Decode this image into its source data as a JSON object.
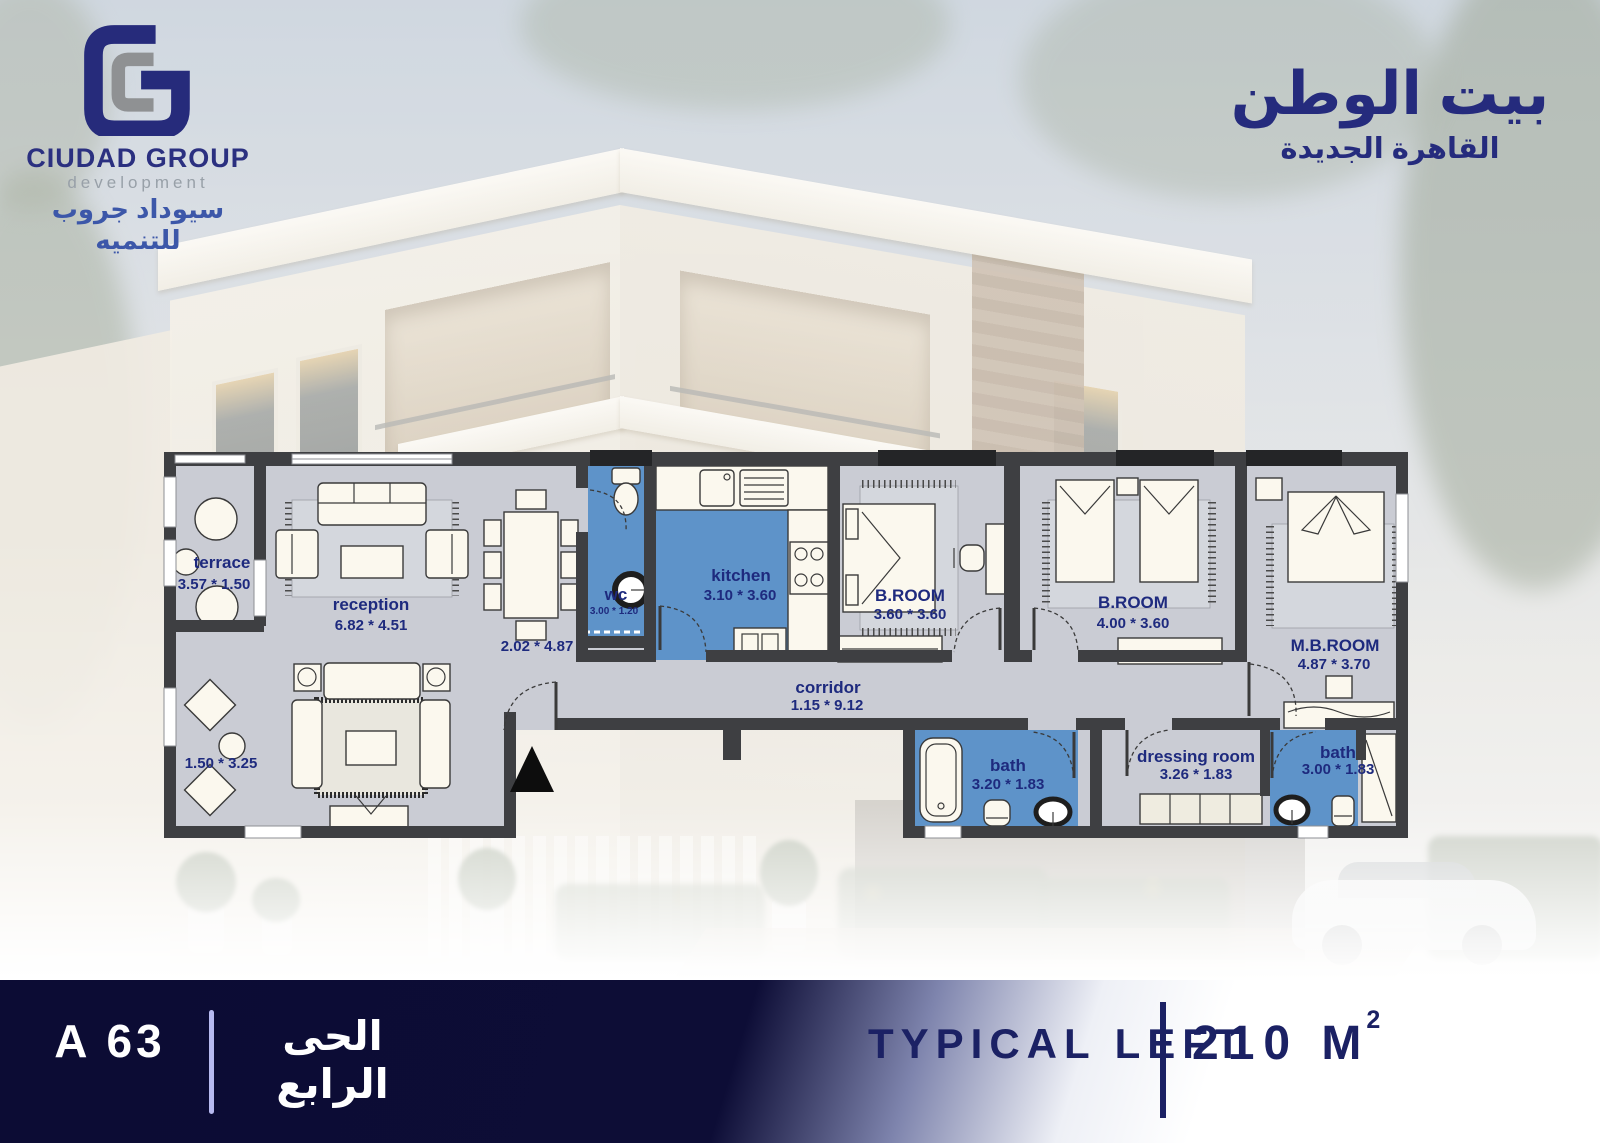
{
  "brand": {
    "company": "CIUDAD GROUP",
    "company_sub": "development",
    "company_arabic": "سيوداد جروب للتنميه"
  },
  "project": {
    "name_arabic": "بيت الوطن",
    "location_arabic": "القاهرة الجديدة"
  },
  "floor_plan": {
    "rooms": [
      {
        "id": "terrace",
        "name": "terrace",
        "dims": "3.57 * 1.50"
      },
      {
        "id": "reception",
        "name": "reception",
        "dims": "6.82 * 4.51"
      },
      {
        "id": "dining",
        "name": "",
        "dims": "2.02 * 4.87"
      },
      {
        "id": "wc",
        "name": "wc",
        "dims": "3.00 * 1.20"
      },
      {
        "id": "kitchen",
        "name": "kitchen",
        "dims": "3.10 * 3.60"
      },
      {
        "id": "bedroom-1",
        "name": "B.ROOM",
        "dims": "3.60 * 3.60"
      },
      {
        "id": "bedroom-2",
        "name": "B.ROOM",
        "dims": "4.00 * 3.60"
      },
      {
        "id": "master-bedroom",
        "name": "M.B.ROOM",
        "dims": "4.87 * 3.70"
      },
      {
        "id": "corridor",
        "name": "corridor",
        "dims": "1.15 * 9.12"
      },
      {
        "id": "bath-1",
        "name": "bath",
        "dims": "3.20 * 1.83"
      },
      {
        "id": "dressing-room",
        "name": "dressing room",
        "dims": "3.26 * 1.83"
      },
      {
        "id": "bath-2",
        "name": "bath",
        "dims": "3.00 * 1.83"
      },
      {
        "id": "sitting-corner",
        "name": "",
        "dims": "1.50 * 3.25"
      }
    ]
  },
  "footer": {
    "unit_code": "A 63",
    "district_arabic": "الحى الرابع",
    "layout_name": "TYPICAL LEFT",
    "area": "210 M",
    "area_exponent": "2"
  },
  "colors": {
    "accent_navy": "#1e2a7e",
    "room_blue": "#5e93c9",
    "floor_gray": "#caccd4",
    "wall_dark": "#3e3f42",
    "footer_navy": "#0c0c34",
    "divider_lavender": "#b7baf0"
  }
}
